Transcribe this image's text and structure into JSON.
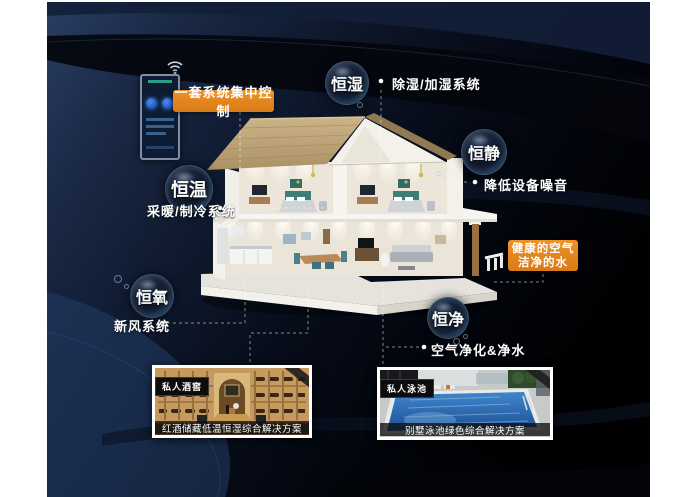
{
  "meta": {
    "theme": "smart-home constant-system infographic",
    "colors": {
      "accent_orange": "#e0841f",
      "background_navy": "#0b1528",
      "bubble_rim": "#82aad2",
      "text": "#ffffff"
    }
  },
  "control_panel": {
    "label": "一套系统集中控制",
    "wifi_icon": "wifi"
  },
  "bubbles": [
    {
      "id": "heng-shi",
      "label": "恒湿",
      "desc": "除湿/加湿系统"
    },
    {
      "id": "heng-jing",
      "label": "恒静",
      "desc": "降低设备噪音"
    },
    {
      "id": "heng-wen",
      "label": "恒温",
      "desc": "采暖/制冷系统"
    },
    {
      "id": "heng-yang",
      "label": "恒氧",
      "desc": "新风系统"
    },
    {
      "id": "heng-jing2",
      "label": "恒净",
      "desc": "空气净化&净水"
    }
  ],
  "highlight_box": {
    "line1": "健康的空气",
    "line2": "洁净的水"
  },
  "photos": [
    {
      "tag": "私人酒窖",
      "caption": "红酒储藏低温恒湿综合解决方案"
    },
    {
      "tag": "私人泳池",
      "caption": "别墅泳池绿色综合解决方案"
    }
  ]
}
